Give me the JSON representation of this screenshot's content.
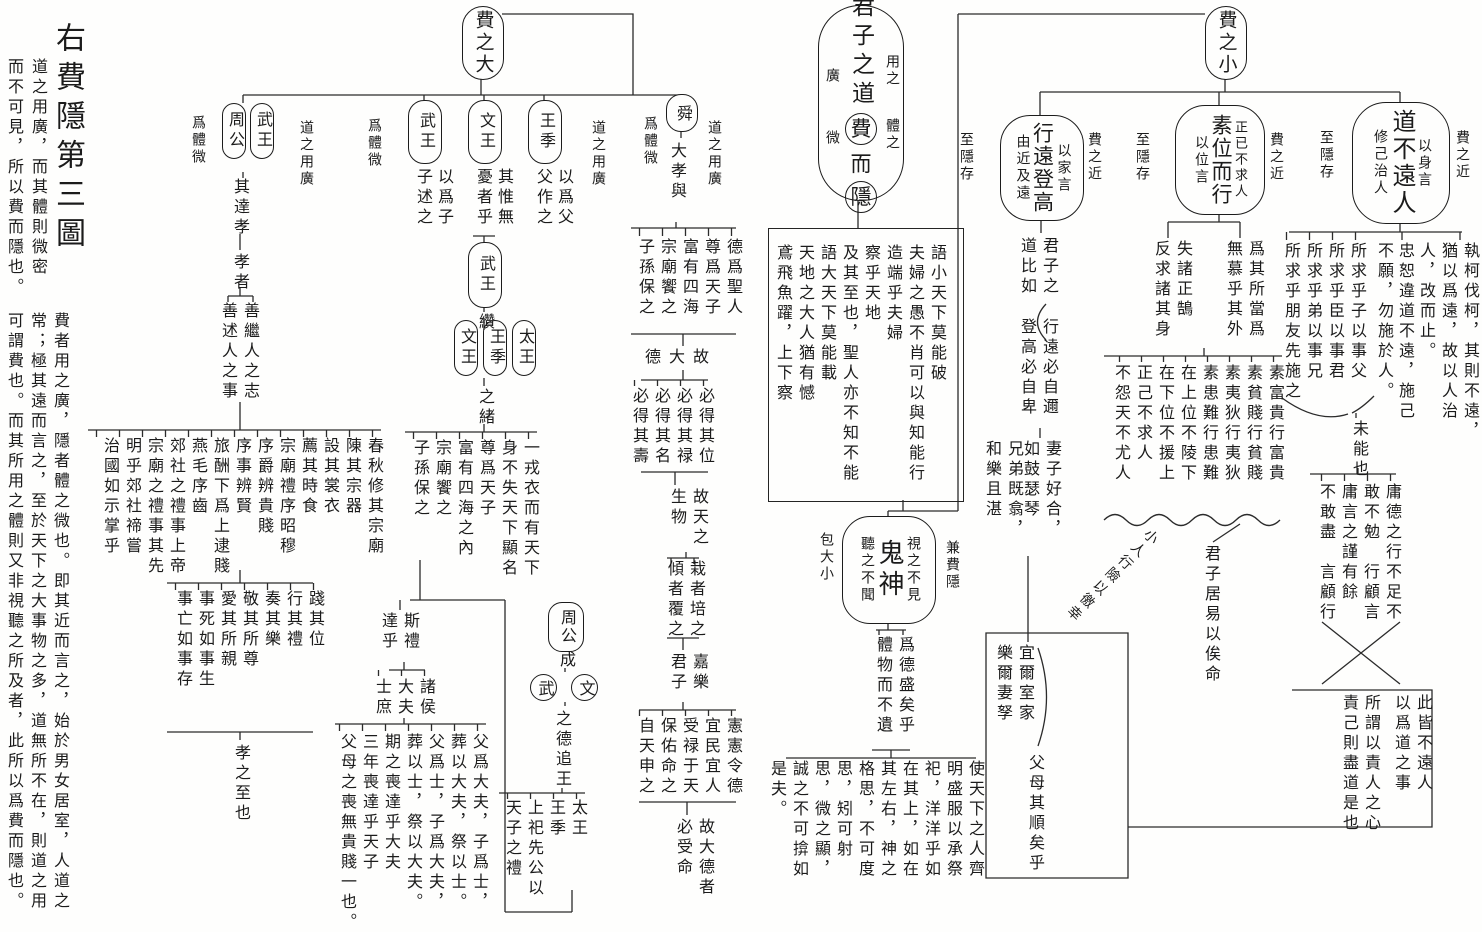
{
  "margin": {
    "title": "右費隱第三圖",
    "note1_cols": [
      "道之用廣，而其體則微密",
      "而不可見，所以費而隱也。"
    ],
    "note2_cols": [
      "費者用之廣，隱者體之微也。即其近而言之，始於男女居室，人道之",
      "常；極其遠而言之，至於天下之大事物之多，道無所不在，則道之用",
      "可謂費也。而其所用之體則又非視聽之所及者，此所以爲費而隱也。"
    ]
  },
  "main": {
    "node_pre": "君子之道",
    "node_fei": "費",
    "node_er": "而",
    "node_yin": "隱",
    "right_notes": [
      "用之",
      "體之"
    ],
    "left_notes": [
      "廣",
      "微"
    ],
    "columns": [
      "語小天下莫能破",
      "夫婦之愚不肖可以與知能行",
      "造端乎夫婦",
      "察乎天地",
      "及其至也，聖人亦不知不能",
      "語大天下莫能載",
      "天地之大人猶有憾",
      "鳶飛魚躍，上下察"
    ]
  },
  "fei_da": {
    "label": "費之大",
    "zhougong_wuwang": {
      "ovals": [
        "武王",
        "周公"
      ],
      "note_left": "爲體微",
      "note_right": "道之用廣",
      "chain1": "其達孝",
      "chain2": "孝者",
      "pair": [
        "善繼人之志",
        "善述人之事"
      ],
      "rites": [
        "春秋修其宗廟",
        "陳其宗器",
        "設其裳衣",
        "薦其時食",
        "宗廟禮序昭穆",
        "序爵辨貴賤",
        "序事辨賢",
        "旅酬下爲上逮賤",
        "燕毛序齒",
        "郊社之禮事上帝",
        "宗廟之禮事其先",
        "明乎郊社禘嘗",
        "治國如示掌乎"
      ],
      "practice": [
        "踐其位",
        "行其禮",
        "奏其樂",
        "敬其所尊",
        "愛其所親",
        "事死如事生",
        "事亡如事存"
      ],
      "conclusion": "孝之至也"
    },
    "wu_wen_ji": {
      "note_left": "爲體微",
      "note_right": "道之用廣",
      "wang_ji": {
        "label": "王季",
        "notes": [
          "以爲父",
          "父作之"
        ]
      },
      "wen_wang": {
        "label": "文王",
        "notes": [
          "其惟無",
          "憂者乎"
        ]
      },
      "wu_wang": {
        "label": "武王",
        "notes": [
          "以爲子",
          "子述之"
        ]
      },
      "mid_oval": "武王",
      "zuan": "纘",
      "ancestor_ovals": [
        "太王",
        "王季",
        "文王"
      ],
      "xu": "之緒",
      "columns": [
        "一戎衣而有天下",
        "身不失天下顯名",
        "尊爲天子",
        "富有四海之內",
        "宗廟饗之",
        "子孫保之"
      ]
    },
    "zhougong_cheng": {
      "oval": "周公",
      "cheng": "成",
      "circles": [
        "文",
        "武"
      ],
      "tail": "之德追王",
      "columns": [
        "太王",
        "王季",
        "上祀先公以",
        "天子之禮"
      ]
    },
    "si_li": {
      "head": [
        "斯禮",
        "達乎"
      ],
      "ranks": [
        "諸侯",
        "大夫",
        "士庶"
      ],
      "columns": [
        "父爲大夫，子爲士，",
        "葬以大夫，祭以士。",
        "父爲士，子爲大夫，",
        "葬以士，祭以大夫。",
        "期之喪達乎大夫",
        "三年喪達乎天子",
        "父母之喪無貴賤一也。"
      ]
    },
    "shun": {
      "oval": "舜",
      "note_left": "爲體微",
      "note_right": "道之用廣",
      "sub": "大孝與",
      "cols1": [
        "德爲聖人",
        "尊爲天子",
        "富有四海",
        "宗廟饗之",
        "子孫保之"
      ],
      "link1": [
        "故",
        "大",
        "德"
      ],
      "cols2": [
        "必得其位",
        "必得其禄",
        "必得其名",
        "必得其壽"
      ],
      "link2": [
        "故天之",
        "生物"
      ],
      "cols3": [
        "栽者培之",
        "傾者覆之"
      ],
      "link3": [
        "嘉樂",
        "君子"
      ],
      "cols4": [
        "憲憲令德",
        "宜民宜人",
        "受禄于天",
        "保佑命之",
        "自天申之"
      ],
      "conclusion": [
        "故大德者",
        "必受命"
      ]
    }
  },
  "guishen": {
    "oval": "鬼神",
    "inside_right": "視之不見",
    "inside_left": "聽之不聞",
    "label_right": "兼費隱",
    "label_left": "包大小",
    "pair": [
      "爲德盛矣乎",
      "體物而不遺"
    ],
    "passage": "使天下之人齊明盛服以承祭祀，洋洋乎如在其上，如在其左右，神之格思，不可度思，矧可射思，微之顯，誠之不可揜如是夫。"
  },
  "fei_xiao": {
    "label": "費之小",
    "xing_yuan": {
      "oval": "行遠登高",
      "inside_right": "以家言",
      "inside_left": "由近及遠",
      "outer_right": "費之近",
      "outer_left": "至隱存",
      "chain": [
        "君子之",
        "道比如"
      ],
      "pair": [
        "行遠必自邇",
        "登高必自卑"
      ],
      "poem1": "妻子好合，如鼓瑟琴",
      "poem2": "兄弟既翕，和樂且湛",
      "pair2": [
        "宜爾室家",
        "樂爾妻孥"
      ],
      "conclusion": "父母其順矣乎"
    },
    "su_wei": {
      "oval": "素位而行",
      "inside_right": "正已不求人",
      "inside_left": "以位言",
      "outer_right": "費之近",
      "outer_left": "至隱存",
      "pair1": [
        "爲其所當爲",
        "無慕乎其外"
      ],
      "pair2": [
        "失諸正鵠",
        "反求諸其身"
      ],
      "columns": [
        "素富貴行富貴",
        "素貧賤行貧賤",
        "素夷狄行夷狄",
        "素患難行患難",
        "在上位不陵下",
        "在下位不援上",
        "正己不求人",
        "不怨天不尤人"
      ],
      "junzi": "君子居易以俟命",
      "xiaoren": "小人行險以徼幸"
    },
    "dao_bu_yuan": {
      "oval": "道不遠人",
      "inside_right": "以身言",
      "inside_left": "修己治人",
      "outer_right": "費之近",
      "outer_left": "至隱存",
      "para1": "執柯伐柯，其則不遠，猶以爲遠，故以人治人，改而止。",
      "para2": "忠恕違道不遠，施己不願，勿施於人。",
      "columns": [
        "所求乎子以事父",
        "所求乎臣以事君",
        "所求乎弟以事兄",
        "所求乎朋友先施之"
      ],
      "unable": "未能也",
      "pairs": [
        "庸德之行不足不",
        "敢不勉　行顧言",
        "庸言之謹有餘",
        "不敢盡　言顧行"
      ],
      "concl1": [
        "此皆不遠人",
        "以爲道之事"
      ],
      "concl2": [
        "所謂以責人之心",
        "責己則盡道是也"
      ]
    }
  }
}
